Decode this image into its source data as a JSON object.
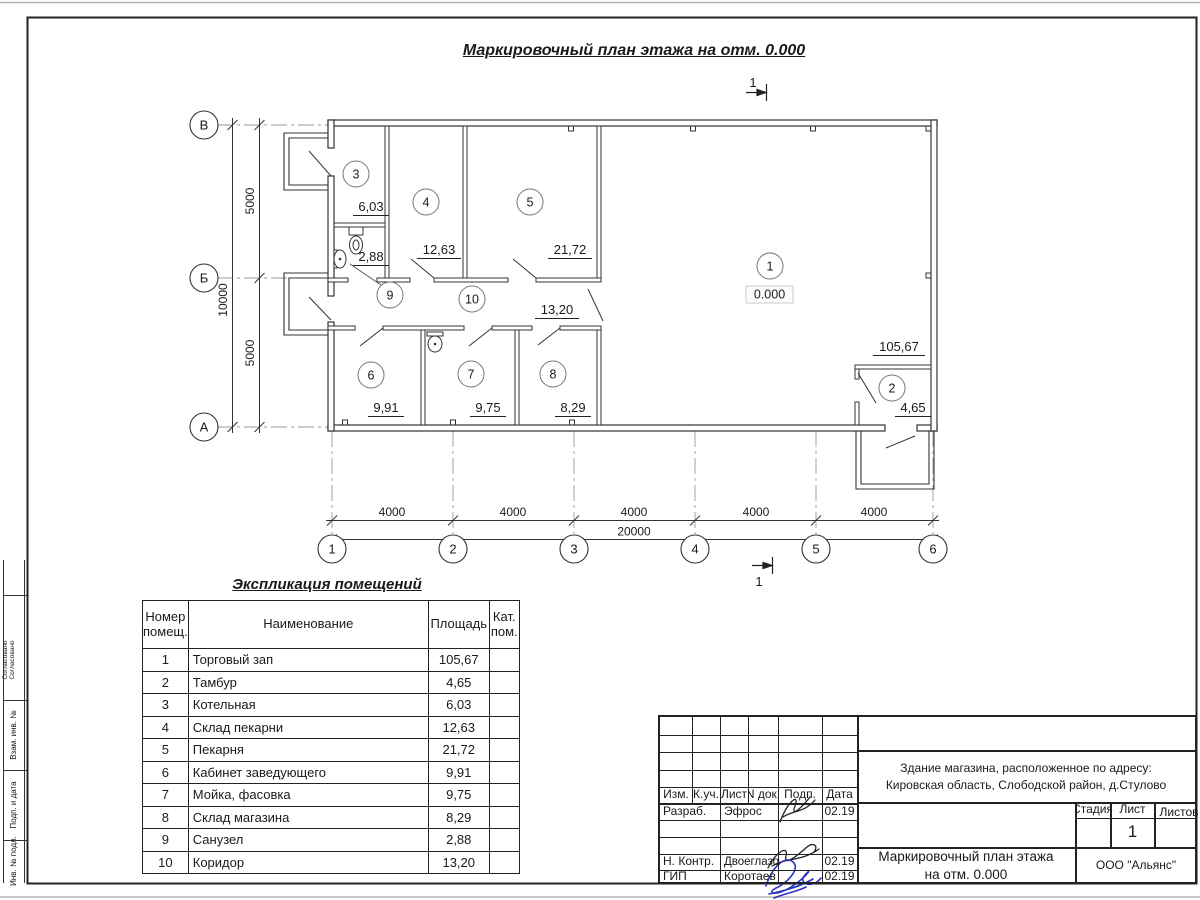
{
  "sheet": {
    "title": "Маркировочный план этажа на отм. 0.000",
    "section_label": "1"
  },
  "plan": {
    "elevation": "0.000",
    "axes_bottom": [
      "1",
      "2",
      "3",
      "4",
      "5",
      "6"
    ],
    "axes_left": [
      "В",
      "Б",
      "А"
    ],
    "rooms": [
      {
        "num": "1",
        "area": "105,67"
      },
      {
        "num": "2",
        "area": "4,65"
      },
      {
        "num": "3",
        "area": "6,03"
      },
      {
        "num": "4",
        "area": "12,63"
      },
      {
        "num": "5",
        "area": "21,72"
      },
      {
        "num": "6",
        "area": "9,91"
      },
      {
        "num": "7",
        "area": "9,75"
      },
      {
        "num": "8",
        "area": "8,29"
      },
      {
        "num": "9",
        "area": "2,88"
      },
      {
        "num": "10",
        "area": "13,20"
      }
    ],
    "dims": {
      "bay": "4000",
      "total": "20000",
      "left_half": "5000",
      "left_total": "10000"
    }
  },
  "table": {
    "title": "Экспликация помещений",
    "headers": {
      "num1": "Номер",
      "num2": "помещ.",
      "name": "Наименование",
      "area": "Площадь",
      "cat1": "Кат.",
      "cat2": "пом."
    },
    "rows": [
      {
        "num": "1",
        "name": "Торговый зап",
        "area": "105,67",
        "cat": ""
      },
      {
        "num": "2",
        "name": "Тамбур",
        "area": "4,65",
        "cat": ""
      },
      {
        "num": "3",
        "name": "Котельная",
        "area": "6,03",
        "cat": ""
      },
      {
        "num": "4",
        "name": "Склад пекарни",
        "area": "12,63",
        "cat": ""
      },
      {
        "num": "5",
        "name": "Пекарня",
        "area": "21,72",
        "cat": ""
      },
      {
        "num": "6",
        "name": "Кабинет заведующего",
        "area": "9,91",
        "cat": ""
      },
      {
        "num": "7",
        "name": "Мойка, фасовка",
        "area": "9,75",
        "cat": ""
      },
      {
        "num": "8",
        "name": "Склад магазина",
        "area": "8,29",
        "cat": ""
      },
      {
        "num": "9",
        "name": "Санузел",
        "area": "2,88",
        "cat": ""
      },
      {
        "num": "10",
        "name": "Коридор",
        "area": "13,20",
        "cat": ""
      }
    ]
  },
  "titleblock": {
    "cols": {
      "izm": "Изм.",
      "kuch": "К.уч.",
      "list": "Лист",
      "ndok": "N док.",
      "podp": "Подп.",
      "data": "Дата"
    },
    "rows": [
      {
        "role": "Разраб.",
        "name": "Эфрос",
        "date": "02.19"
      },
      {
        "role": "Н. Контр.",
        "name": "Двоеглазов",
        "date": "02.19"
      },
      {
        "role": "ГИП",
        "name": "Коротаев",
        "date": "02.19"
      }
    ],
    "address_line1": "Здание магазина, расположенное по адресу:",
    "address_line2": "Кировская область, Слободской район, д.Стулово",
    "stage_label": "Стадия",
    "sheet_label": "Лист",
    "sheets_label": "Листов",
    "sheet_num": "1",
    "doc_title_line1": "Маркировочный план этажа",
    "doc_title_line2": "на отм. 0.000",
    "company": "ООО \"Альянс\""
  },
  "left_strip": {
    "approval": "Согласовано",
    "l2": "Взам. инв. №",
    "l3": "Подп. и дата",
    "l4": "Инв. № подл."
  }
}
